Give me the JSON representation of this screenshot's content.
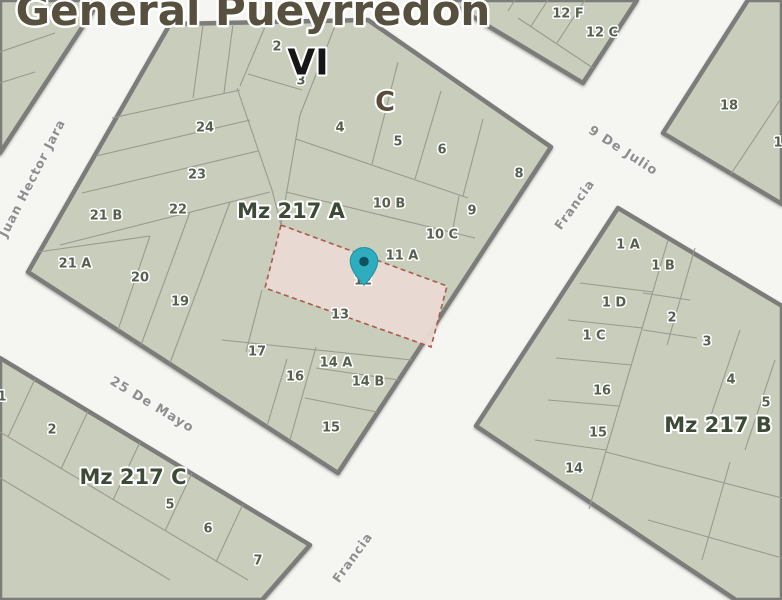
{
  "title": "General Pueyrredon",
  "overlay": {
    "zone_code": "VI",
    "section_code": "C"
  },
  "streets": {
    "west": "Juan Hector Jara",
    "south": "25 De Mayo",
    "northeast": "9 De Julio",
    "east": "Francia",
    "south_center": "Francia"
  },
  "blocks": {
    "a": {
      "name": "Mz 217 A",
      "parcels": [
        "2",
        "3",
        "4",
        "5",
        "6",
        "8",
        "24",
        "23",
        "22",
        "10 B",
        "9",
        "10 C",
        "11 A",
        "21 B",
        "21 A",
        "20",
        "19",
        "12",
        "13",
        "17",
        "16",
        "14 A",
        "14 B",
        "15"
      ]
    },
    "b": {
      "name": "Mz 217 B",
      "parcels": [
        "1 A",
        "1 B",
        "1 D",
        "2",
        "1 C",
        "3",
        "4",
        "5",
        "16",
        "15",
        "14"
      ]
    },
    "c": {
      "name": "Mz 217 C",
      "parcels": [
        "1",
        "2",
        "5",
        "6",
        "7"
      ]
    },
    "ne": {
      "parcels": [
        "18",
        "1"
      ]
    },
    "nw": {
      "parcels": [
        "12 F",
        "12 C"
      ]
    }
  },
  "selection": {
    "highlighted_parcel": "12",
    "block": "Mz 217 A"
  },
  "colors": {
    "parcel_fill": "#c9cdbb",
    "street_bg": "#f5f5f2",
    "block_border": "#7c7c7a",
    "highlight_fill": "#e9dbd3",
    "highlight_border": "#a85b4d",
    "marker_teal": "#2eadbf",
    "marker_dot": "#0f525f"
  }
}
